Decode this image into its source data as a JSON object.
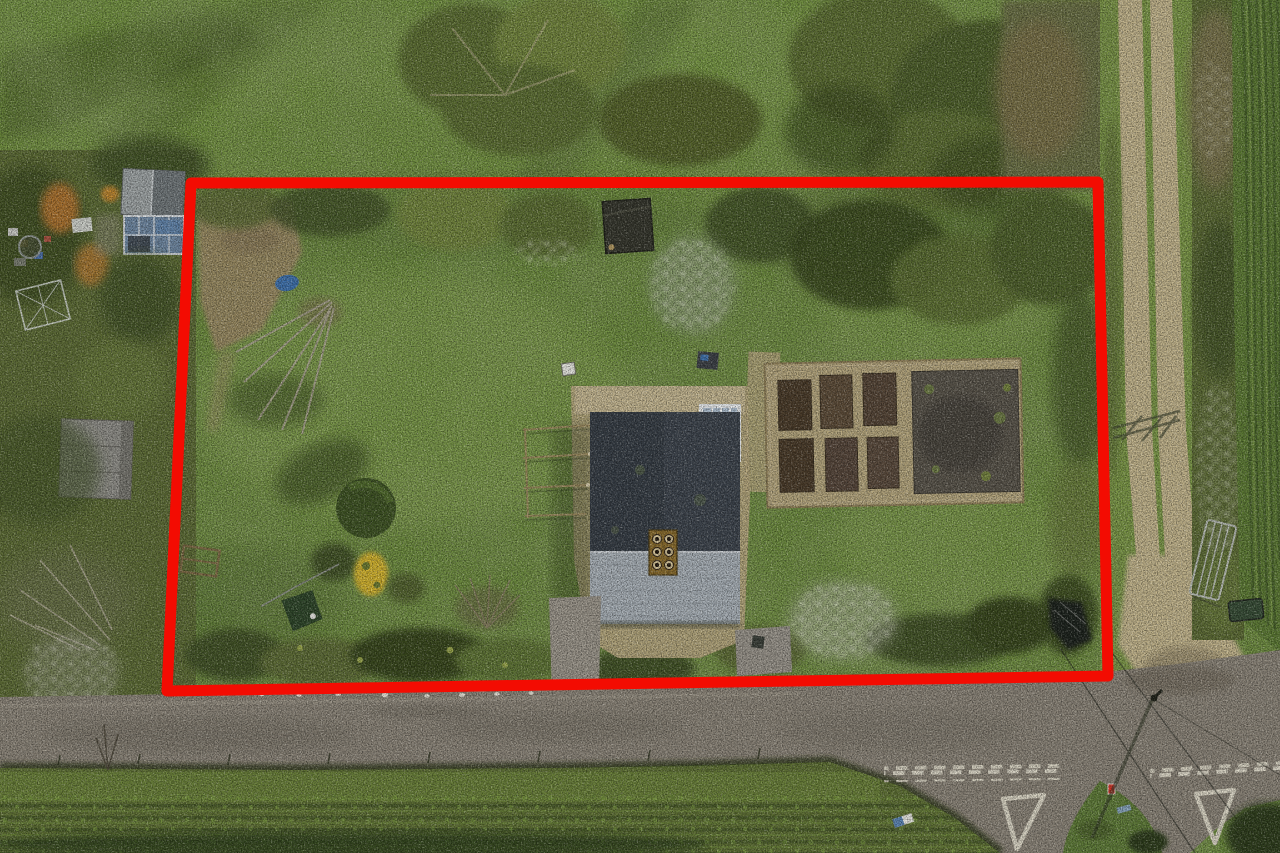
{
  "meta": {
    "type": "aerial-drone-photograph",
    "subject": "Overhead aerial photo of a detached rural house and large garden plot outlined with a red property-boundary annotation, beside a country road junction and farm track",
    "width_px": 1280,
    "height_px": 853
  },
  "annotation": {
    "boundary_points": "191,183 1098,182 1108,676 167,691",
    "boundary_color": "#f30c02",
    "boundary_stroke_width": 11
  },
  "palette": {
    "boundary": "#f30c02",
    "fieldTop": "#71913e",
    "lawn": "#6d8c3e",
    "lawnLight": "#86a351",
    "lawnDark": "#50682e",
    "canopy": "#5c6e31",
    "canopyLight": "#72853c",
    "canopyDark": "#39471f",
    "scrub": "#5d6c35",
    "hedgeDark": "#425226",
    "road": "#8b8478",
    "roadWear": "#6f6a5e",
    "verge": "#70893c",
    "gravel": "#b5a67d",
    "gravelLight": "#c9bb97",
    "soilBed": "#4a3b29",
    "soilPlot": "#59544a",
    "roofShade": "#3d444d",
    "roofLit": "#a9b1b8",
    "chimney": "#8a6c2c",
    "glass": "#aebfd0",
    "frameWhite": "#e9ecee",
    "track": "#c3b58c",
    "median": "#7c9847",
    "crop": "#5d7b34",
    "cropRow": "#465f2a",
    "blossom": "#efeee2",
    "earth": "#9b8a64",
    "marking": "#dcd7c6",
    "autumn": "#b0732f",
    "yellowBush": "#d2b32f",
    "waterBlue": "#3f7fc0",
    "shadow": "#2c3818"
  },
  "features": {
    "vegetable_garden": {
      "raised_beds": 6,
      "large_soil_plots": 1
    },
    "house": {
      "chimney_pots": 6,
      "conservatory_panels": 4
    },
    "road_markings": {
      "give_way_triangles": 2,
      "double_dashed_lines": 2
    },
    "traffic_island_signs": 2
  }
}
